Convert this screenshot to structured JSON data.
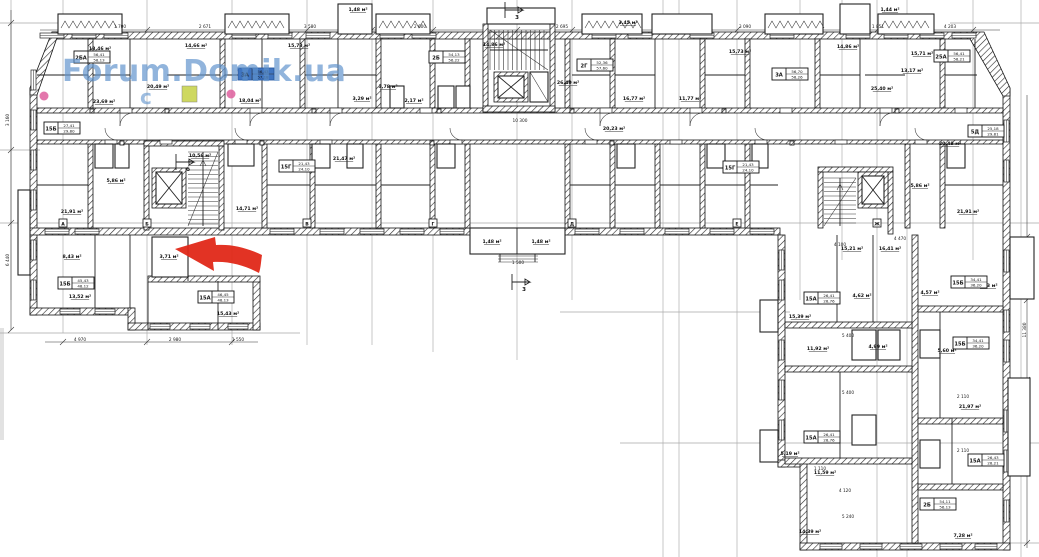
{
  "page": {
    "background": "#ffffff"
  },
  "watermark": {
    "text": "Forum.Domik.ua",
    "fragment": "c",
    "color": "#5e92cc"
  },
  "annotations": {
    "arrow": {
      "label": "red-highlight-arrow",
      "color": "#e02818"
    },
    "highlight_room": {
      "color": "#c9d44f"
    },
    "dot_color": "#de5f9d"
  },
  "floor_plan": {
    "apartments": [
      {
        "type": "2БА",
        "a1": "56,41",
        "a2": "58,13",
        "x": 92,
        "y": 57,
        "blue": false
      },
      {
        "type": "15Б",
        "a1": "27,41",
        "a2": "29,80",
        "x": 62,
        "y": 128,
        "blue": false
      },
      {
        "type": "3А",
        "a1": "56,43",
        "a2": "57,18",
        "x": 256,
        "y": 74,
        "blue": true
      },
      {
        "type": "15Г",
        "a1": "21,43",
        "a2": "24,10",
        "x": 297,
        "y": 166,
        "blue": false
      },
      {
        "type": "2Б",
        "a1": "54,13",
        "a2": "56,22",
        "x": 447,
        "y": 57,
        "blue": false
      },
      {
        "type": "2Г",
        "a1": "52,36",
        "a2": "57,60",
        "x": 595,
        "y": 65,
        "blue": false
      },
      {
        "type": "3А",
        "a1": "56,70",
        "a2": "58,26",
        "x": 790,
        "y": 74,
        "blue": false
      },
      {
        "type": "15Г",
        "a1": "21,43",
        "a2": "24,10",
        "x": 741,
        "y": 167,
        "blue": false
      },
      {
        "type": "25А",
        "a1": "56,41",
        "a2": "58,21",
        "x": 952,
        "y": 56,
        "blue": false
      },
      {
        "type": "5Д",
        "a1": "25,18",
        "a2": "29,81",
        "x": 986,
        "y": 131,
        "blue": false
      },
      {
        "type": "15Б",
        "a1": "45,43",
        "a2": "48,12",
        "x": 76,
        "y": 283,
        "blue": false
      },
      {
        "type": "15А",
        "a1": "46,45",
        "a2": "48,13",
        "x": 216,
        "y": 297,
        "blue": false
      },
      {
        "type": "15А",
        "a1": "26,41",
        "a2": "28,76",
        "x": 822,
        "y": 298,
        "blue": false
      },
      {
        "type": "15Б",
        "a1": "34,41",
        "a2": "36,20",
        "x": 969,
        "y": 282,
        "blue": false
      },
      {
        "type": "15Б",
        "a1": "34,41",
        "a2": "36,20",
        "x": 971,
        "y": 343,
        "blue": false
      },
      {
        "type": "15А",
        "a1": "26,41",
        "a2": "28,76",
        "x": 822,
        "y": 437,
        "blue": false
      },
      {
        "type": "15А",
        "a1": "26,43",
        "a2": "28,21",
        "x": 986,
        "y": 460,
        "blue": false
      },
      {
        "type": "2Б",
        "a1": "54,11",
        "a2": "56,13",
        "x": 938,
        "y": 504,
        "blue": false
      }
    ],
    "rooms": [
      {
        "t": "13,46 м²",
        "x": 100,
        "y": 50
      },
      {
        "t": "14,66 м²",
        "x": 196,
        "y": 47
      },
      {
        "t": "15,73 м²",
        "x": 299,
        "y": 47
      },
      {
        "t": "20,49 м²",
        "x": 158,
        "y": 88
      },
      {
        "t": "23,69 м²",
        "x": 104,
        "y": 103
      },
      {
        "t": "18,04 м²",
        "x": 250,
        "y": 102
      },
      {
        "t": "21,47 м²",
        "x": 344,
        "y": 160
      },
      {
        "t": "3,29 м²",
        "x": 362,
        "y": 100
      },
      {
        "t": "2,17 м²",
        "x": 414,
        "y": 102
      },
      {
        "t": "14,86 м²",
        "x": 494,
        "y": 46
      },
      {
        "t": "26,40 м²",
        "x": 568,
        "y": 84
      },
      {
        "t": "16,77 м²",
        "x": 634,
        "y": 100
      },
      {
        "t": "3,78 м²",
        "x": 388,
        "y": 88
      },
      {
        "t": "20,23 м²",
        "x": 614,
        "y": 130
      },
      {
        "t": "10,56 м²",
        "x": 200,
        "y": 157
      },
      {
        "t": "15,73 м²",
        "x": 740,
        "y": 53
      },
      {
        "t": "14,86 м²",
        "x": 848,
        "y": 48
      },
      {
        "t": "15,71 м²",
        "x": 922,
        "y": 55
      },
      {
        "t": "13,17 м²",
        "x": 912,
        "y": 72
      },
      {
        "t": "25,40 м²",
        "x": 882,
        "y": 90
      },
      {
        "t": "20,48 м²",
        "x": 950,
        "y": 145
      },
      {
        "t": "11,77 м²",
        "x": 690,
        "y": 100
      },
      {
        "t": "5,86 м²",
        "x": 920,
        "y": 187
      },
      {
        "t": "21,91 м²",
        "x": 968,
        "y": 213
      },
      {
        "t": "21,91 м²",
        "x": 72,
        "y": 213
      },
      {
        "t": "5,86 м²",
        "x": 116,
        "y": 182
      },
      {
        "t": "8,43 м²",
        "x": 72,
        "y": 258
      },
      {
        "t": "3,71 м²",
        "x": 169,
        "y": 258
      },
      {
        "t": "15,43 м²",
        "x": 228,
        "y": 315
      },
      {
        "t": "13,52 м²",
        "x": 80,
        "y": 298
      },
      {
        "t": "14,71 м²",
        "x": 247,
        "y": 210
      },
      {
        "t": "1,48 м²",
        "x": 492,
        "y": 243
      },
      {
        "t": "1,48 м²",
        "x": 541,
        "y": 243
      },
      {
        "t": "1,48 м²",
        "x": 358,
        "y": 11
      },
      {
        "t": "1,44 м²",
        "x": 890,
        "y": 11
      },
      {
        "t": "3,45 м²",
        "x": 628,
        "y": 24
      },
      {
        "t": "5,19 м²",
        "x": 790,
        "y": 455
      },
      {
        "t": "15,39 м²",
        "x": 800,
        "y": 318
      },
      {
        "t": "11,92 м²",
        "x": 818,
        "y": 350
      },
      {
        "t": "14,39 м²",
        "x": 810,
        "y": 533
      },
      {
        "t": "4,99 м²",
        "x": 878,
        "y": 348
      },
      {
        "t": "4,57 м²",
        "x": 930,
        "y": 294
      },
      {
        "t": "5,60 м²",
        "x": 947,
        "y": 352
      },
      {
        "t": "8,43 м²",
        "x": 988,
        "y": 287
      },
      {
        "t": "7,28 м²",
        "x": 963,
        "y": 537
      },
      {
        "t": "11,59 м²",
        "x": 825,
        "y": 474
      },
      {
        "t": "4,62 м²",
        "x": 862,
        "y": 297
      },
      {
        "t": "21,97 м²",
        "x": 970,
        "y": 408
      },
      {
        "t": "16,41 м²",
        "x": 890,
        "y": 250
      },
      {
        "t": "15,21 м²",
        "x": 852,
        "y": 250
      }
    ],
    "dimensions": [
      {
        "t": "1 700",
        "x": 120,
        "y": 28
      },
      {
        "t": "2 671",
        "x": 205,
        "y": 28
      },
      {
        "t": "3 580",
        "x": 310,
        "y": 28
      },
      {
        "t": "2 600",
        "x": 420,
        "y": 28
      },
      {
        "t": "2 695",
        "x": 562,
        "y": 28
      },
      {
        "t": "3 090",
        "x": 745,
        "y": 28
      },
      {
        "t": "1 851",
        "x": 878,
        "y": 28
      },
      {
        "t": "4 203",
        "x": 950,
        "y": 28
      },
      {
        "t": "3 160",
        "x": 9,
        "y": 120,
        "r": 1
      },
      {
        "t": "6 440",
        "x": 9,
        "y": 260,
        "r": 1
      },
      {
        "t": "4 970",
        "x": 80,
        "y": 341
      },
      {
        "t": "2 980",
        "x": 175,
        "y": 341
      },
      {
        "t": "1 550",
        "x": 238,
        "y": 341
      },
      {
        "t": "10 300",
        "x": 520,
        "y": 122
      },
      {
        "t": "1 500",
        "x": 518,
        "y": 264
      },
      {
        "t": "4 100",
        "x": 840,
        "y": 246
      },
      {
        "t": "4 470",
        "x": 900,
        "y": 240
      },
      {
        "t": "5 400",
        "x": 848,
        "y": 337
      },
      {
        "t": "5 400",
        "x": 848,
        "y": 394
      },
      {
        "t": "1 110",
        "x": 820,
        "y": 470
      },
      {
        "t": "4 120",
        "x": 845,
        "y": 492
      },
      {
        "t": "5 240",
        "x": 848,
        "y": 518
      },
      {
        "t": "2 110",
        "x": 963,
        "y": 398
      },
      {
        "t": "2 110",
        "x": 963,
        "y": 452
      },
      {
        "t": "11 380",
        "x": 1026,
        "y": 330,
        "r": 1
      }
    ],
    "axis_tags": [
      {
        "label": "А",
        "x": 63
      },
      {
        "label": "Б",
        "x": 147
      },
      {
        "label": "В",
        "x": 307
      },
      {
        "label": "Г",
        "x": 433
      },
      {
        "label": "Д",
        "x": 572
      },
      {
        "label": "Е",
        "x": 737
      },
      {
        "label": "Ж",
        "x": 877
      }
    ],
    "section_markers": [
      {
        "label": "3",
        "x": 512,
        "y": 282
      },
      {
        "label": "3",
        "x": 505,
        "y": 10
      },
      {
        "label": "б",
        "x": 176,
        "y": 162
      }
    ]
  }
}
